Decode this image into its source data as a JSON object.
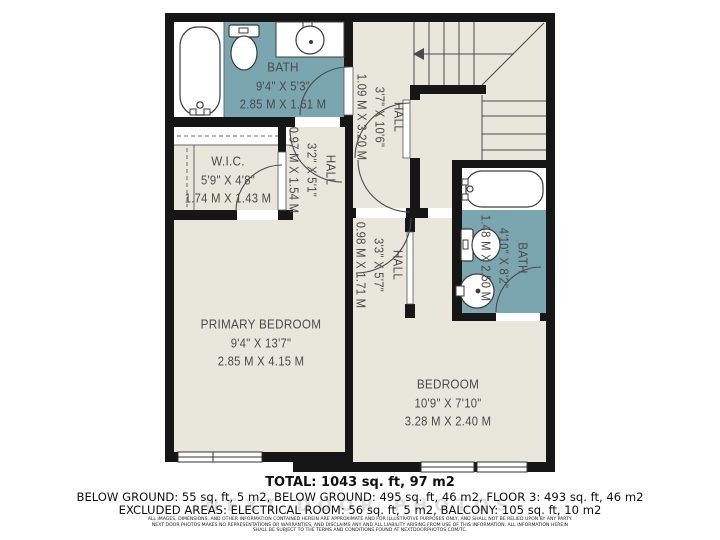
{
  "rooms": [
    {
      "name": "BATH",
      "imperial": "9'4\" X 5'3\"",
      "metric": "2.85 M X 1.61 M"
    },
    {
      "name": "HALL",
      "imperial": "3'7\" X 10'6\"",
      "metric": "1.09 M X 3.20 M"
    },
    {
      "name": "W.I.C.",
      "imperial": "5'9\" X 4'8\"",
      "metric": "1.74 M X 1.43 M"
    },
    {
      "name": "HALL",
      "imperial": "3'2\" X 5'1\"",
      "metric": "0.97 M X 1.54 M"
    },
    {
      "name": "HALL",
      "imperial": "3'3\" X 5'7\"",
      "metric": "0.98 M X 1.71 M"
    },
    {
      "name": "BATH",
      "imperial": "4'10\" X 8'2\"",
      "metric": "1.48 M X 2.50 M"
    },
    {
      "name": "PRIMARY BEDROOM",
      "imperial": "9'4\" X 13'7\"",
      "metric": "2.85 M X 4.15 M"
    },
    {
      "name": "BEDROOM",
      "imperial": "10'9\" X 7'10\"",
      "metric": "3.28 M X 2.40 M"
    }
  ],
  "summary": {
    "total": "TOTAL: 1043 sq. ft, 97 m2",
    "areas": "BELOW GROUND: 55 sq. ft, 5 m2, BELOW GROUND: 495 sq. ft, 46 m2, FLOOR 3: 493 sq. ft, 46 m2",
    "excluded": "EXCLUDED AREAS: ELECTRICAL ROOM: 56 sq. ft, 5 m2, BALCONY: 105 sq. ft, 10 m2"
  },
  "disclaimer": {
    "line1": "ALL IMAGES, DIMENSIONS, AND OTHER INFORMATION CONTAINED HEREIN ARE APPROXIMATE AND FOR ILLUSTRATIVE PURPOSES ONLY, AND SHALL NOT BE RELIED UPON BY ANY PARTY.",
    "line2": "NEXT DOOR PHOTOS MAKES NO REPRESENTATIONS OR WARRANTIES, AND DISCLAIMS ANY AND ALL LIABILITY ARISING FROM USE OF THIS INFORMATION. ALL INFORMATION HEREIN",
    "line3": "SHALL BE SUBJECT TO THE TERMS AND CONDITIONS FOUND AT NEXTDOORPHOTOS.COM/TC."
  },
  "watermark": "NEXT DOOR PHOTOS",
  "colors": {
    "wall": "#161616",
    "floor": "#e9e7dc",
    "bath_fill": "#7aa6b0",
    "fixture_line": "#3c3c3c",
    "label_text": "#4a4a4a",
    "summary_text": "#101010"
  },
  "icons": {
    "stairs_arrow": "left-arrow",
    "fixtures": [
      "bathtub",
      "toilet",
      "sink",
      "bathtub",
      "toilet",
      "sink"
    ]
  }
}
